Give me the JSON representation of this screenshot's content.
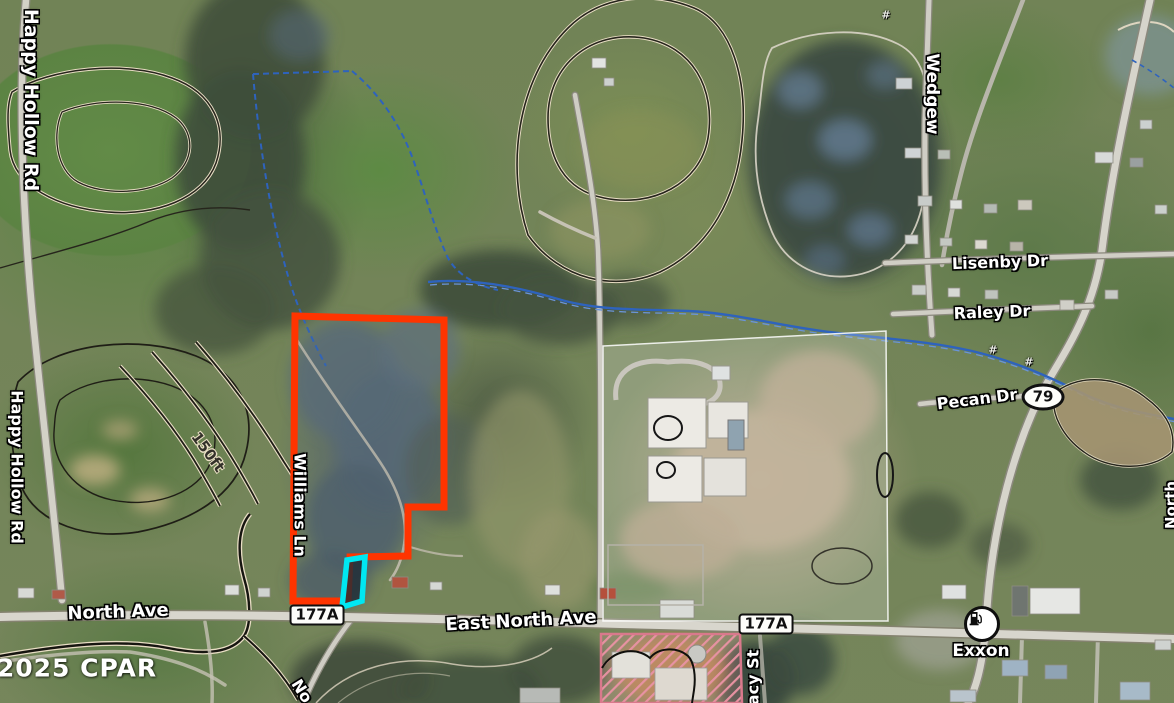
{
  "map": {
    "copyright": "©2025 CPAR",
    "provider_note": "aerial parcel map"
  },
  "labels": {
    "happy_hollow_rd": "Happy Hollow Rd",
    "wedgewood": "Wedgew",
    "lisenby_dr": "Lisenby Dr",
    "raley_dr": "Raley Dr",
    "pecan_dr": "Pecan Dr",
    "north_ave": "North Ave",
    "east_north_ave": "East North Ave",
    "tracy_st": "Tracy St",
    "williams_ln": "Williams Ln",
    "north_partial": "No",
    "right_edge_road": "North",
    "exxon": "Exxon",
    "contour_150ft": "150ft",
    "hash_marker": "#"
  },
  "shields": {
    "route_79": "79",
    "route_177a": "177A"
  },
  "overlays": {
    "selected_parcel_color": "#ff3400",
    "highlight_color": "#00e7f2",
    "zoning_hatch_color": "#e792a2",
    "stream_color": "#2e63bd",
    "school_parcel_tint": "rgba(255,255,255,0.2)"
  }
}
